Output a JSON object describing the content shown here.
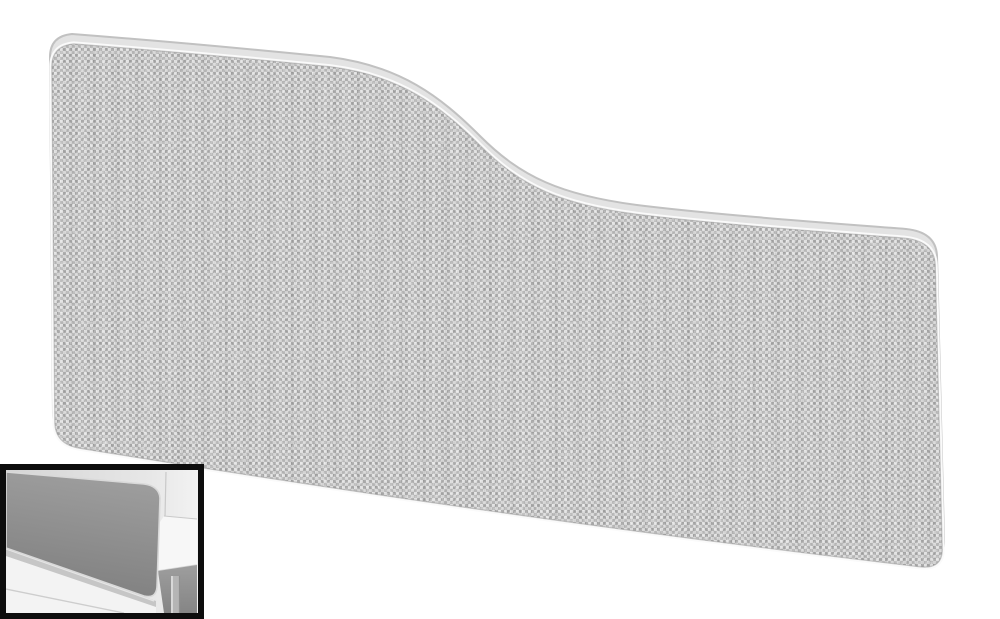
{
  "page": {
    "background": "#ffffff"
  },
  "photo": {
    "subject": "wave-top-desk-screen",
    "trim": {
      "fill": "#e3e3e3",
      "edge": "#c1c1c1",
      "highlight": "#fafafa",
      "contact": "#8d8d8d"
    },
    "fabric": {
      "base": "#c5c5c5",
      "light": "#e8e8e8",
      "soft": "#d8d8d8",
      "mid": "#b2b2b2",
      "dark": "#9c9c9c"
    },
    "inset": {
      "frame": "#0d0d0d",
      "wall": {
        "left": "#d5d5d5",
        "mid": "#e7e7e7",
        "right": "#f2f2f2",
        "corner_line": "#c9c9c9"
      },
      "screen": {
        "top": "#9c9c9c",
        "bottom": "#7d7d7d",
        "trim": "#d9d9d9"
      },
      "rail": {
        "fill": "#c6c6c6",
        "highlight": "#e6e6e6"
      },
      "floor": {
        "fill": "#f3f3f3",
        "line": "#cdcdcd"
      },
      "desk": {
        "top": "#f7f7f7",
        "edge": "#d6d6d6",
        "under_top": "#9e9e9e",
        "under_bottom": "#858585",
        "leg": "#b5b5b5",
        "leg_highlight": "#e3e3e3",
        "leg_shade": "#909090"
      }
    }
  }
}
